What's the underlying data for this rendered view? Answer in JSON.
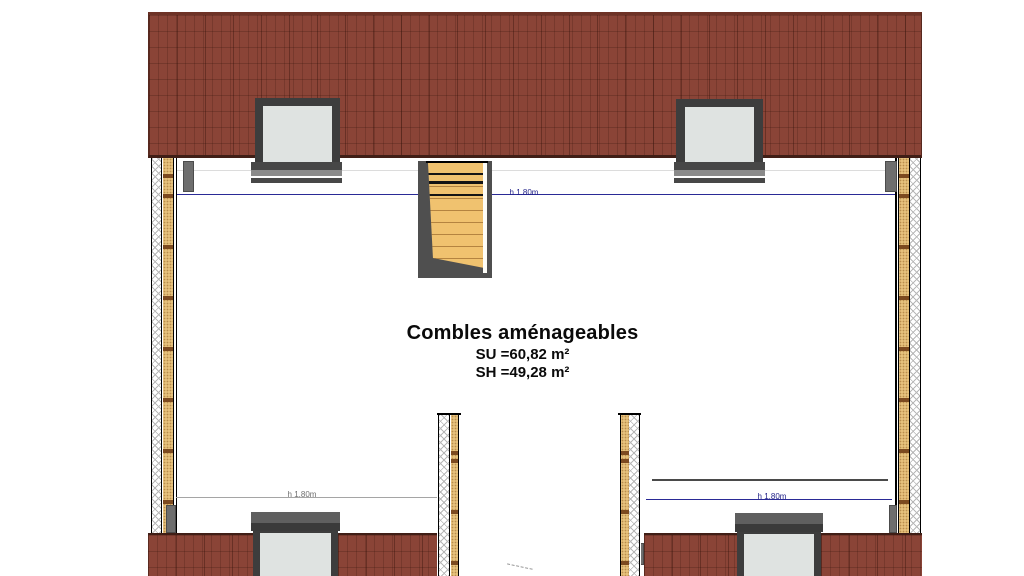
{
  "plan_title": {
    "title": "Combles aménageables",
    "surface_utile": "SU =60,82 m²",
    "surface_habitable": "SH =49,28 m²"
  },
  "dimension_labels": {
    "top": "h 1.80m",
    "bottom_left": "h 1.80m",
    "bottom_right": "h 1.80m"
  },
  "colors": {
    "roof_tile": "#8a4437",
    "roof_edge": "#401e16",
    "stair_tread": "#f0c26f",
    "stair_frame": "#4f4f4f",
    "wall_insulation": "#e9c47f",
    "wall_stud": "#7c4a20",
    "wall_hatch_line": "#b7b7b7",
    "window_glass": "#dfe3e1",
    "window_frame": "#3d3d3d",
    "dimension_blue": "#2a2a96",
    "dimension_gray": "#a5a5a5"
  }
}
